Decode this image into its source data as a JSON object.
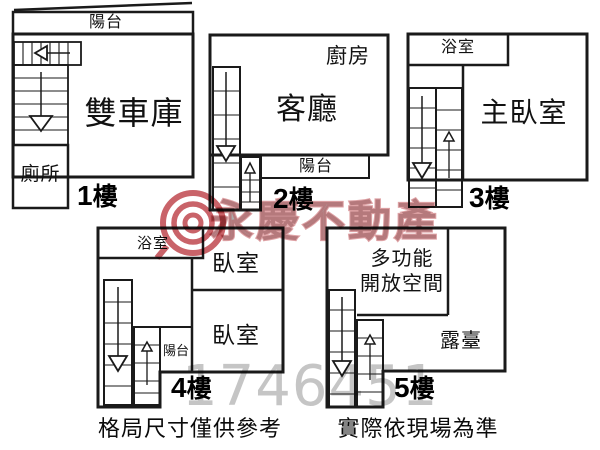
{
  "floors": [
    {
      "label_digit": "1",
      "label_suffix": "樓",
      "rooms": {
        "balcony": "陽台",
        "garage": "雙車庫",
        "toilet": "廁所"
      }
    },
    {
      "label_digit": "2",
      "label_suffix": "樓",
      "rooms": {
        "kitchen": "廚房",
        "living": "客廳",
        "balcony": "陽台"
      }
    },
    {
      "label_digit": "3",
      "label_suffix": "樓",
      "rooms": {
        "bath": "浴室",
        "master": "主臥室"
      }
    },
    {
      "label_digit": "4",
      "label_suffix": "樓",
      "rooms": {
        "bath": "浴室",
        "bedroom_top": "臥室",
        "bedroom_bottom": "臥室",
        "balcony": "陽台"
      }
    },
    {
      "label_digit": "5",
      "label_suffix": "樓",
      "rooms": {
        "multi_line1": "多功能",
        "multi_line2": "開放空間",
        "terrace": "露臺"
      }
    }
  ],
  "watermark": {
    "brand": "永慶不動產",
    "number": "1746451",
    "logo_color": "#c0474e",
    "text_color": "#969696",
    "number_color": "#adadad"
  },
  "footer": {
    "left": "格局尺寸僅供參考",
    "right": "實際依現場為準"
  },
  "colors": {
    "wall": "#1a1a1a",
    "background": "#ffffff"
  }
}
